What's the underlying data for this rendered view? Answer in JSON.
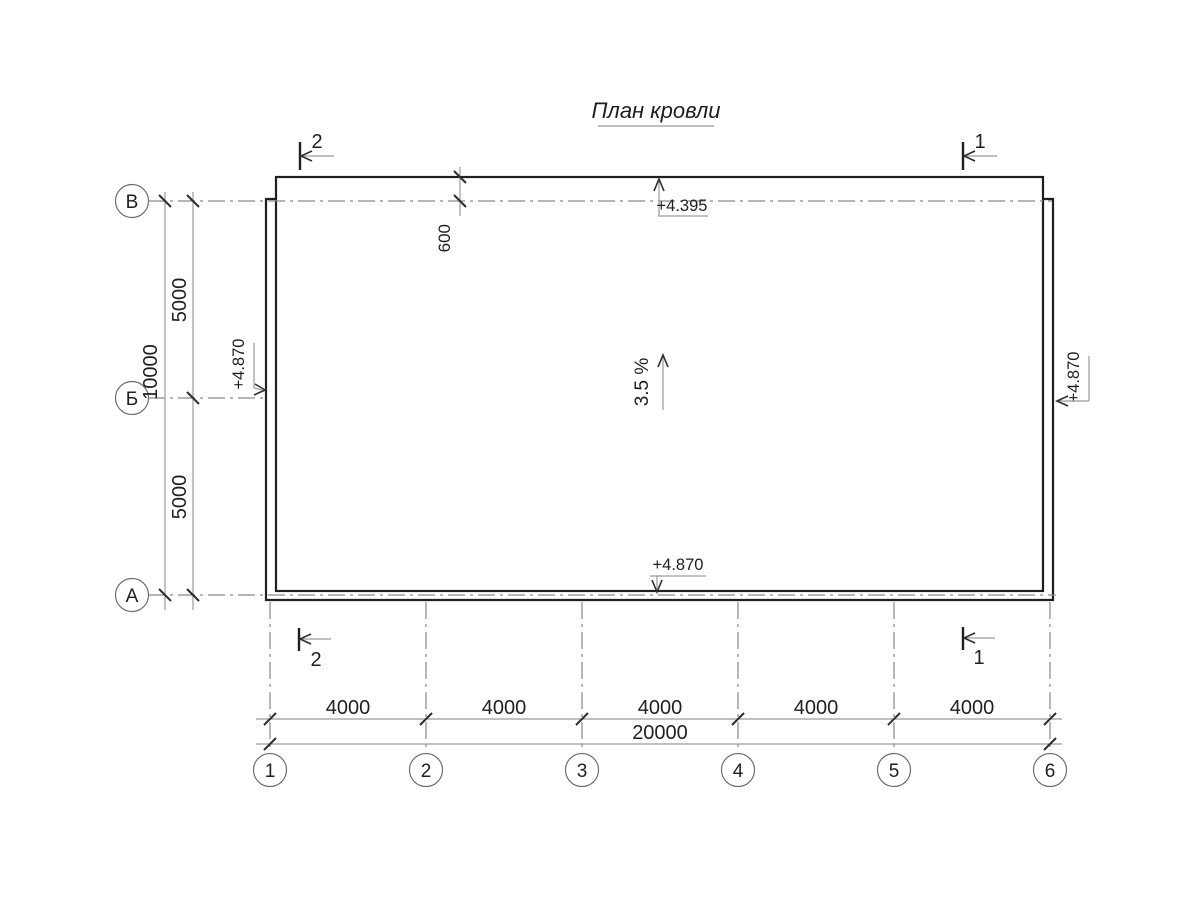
{
  "title": "План кровли",
  "colors": {
    "background": "#ffffff",
    "outline": "#1f1f1f",
    "dimension_line": "#9b9b9b",
    "axis_line": "#8a8a8a",
    "text": "#1f1f1f"
  },
  "row_axes": [
    "В",
    "Б",
    "А"
  ],
  "col_axes": [
    "1",
    "2",
    "3",
    "4",
    "5",
    "6"
  ],
  "dimensions": {
    "left_spans": [
      "5000",
      "5000"
    ],
    "left_total": "10000",
    "eave_offset": "600",
    "bottom_spans": [
      "4000",
      "4000",
      "4000",
      "4000",
      "4000"
    ],
    "bottom_total": "20000"
  },
  "elevations": {
    "eave_top": "+4.395",
    "edge_bottom": "+4.870",
    "edge_left": "+4.870",
    "edge_right": "+4.870"
  },
  "slope": {
    "label": "3.5 %"
  },
  "section_marks": {
    "top_left": "2",
    "top_right": "1",
    "bottom_left": "2",
    "bottom_right": "1"
  }
}
